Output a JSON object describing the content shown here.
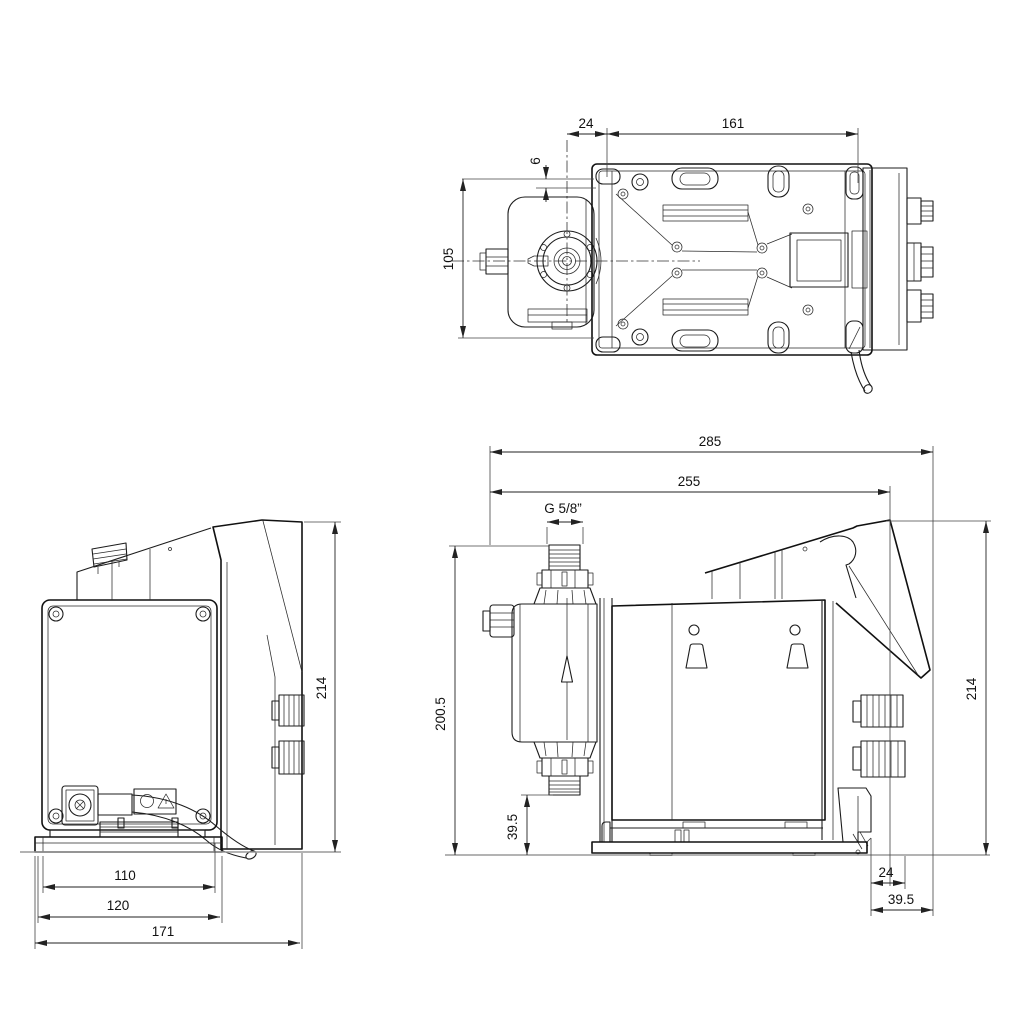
{
  "drawing": {
    "colors": {
      "background": "#ffffff",
      "line": "#1c1c1c",
      "dimension": "#222222"
    },
    "dims": {
      "top": {
        "d24": "24",
        "d161": "161",
        "d6": "6",
        "d105": "105"
      },
      "rear": {
        "d214": "214",
        "d110": "110",
        "d120": "120",
        "d171": "171"
      },
      "side": {
        "d285": "285",
        "d255": "255",
        "thread": "G 5/8”",
        "d200_5": "200.5",
        "d39_5_left": "39.5",
        "d214": "214",
        "d24": "24",
        "d39_5_right": "39.5"
      }
    }
  }
}
